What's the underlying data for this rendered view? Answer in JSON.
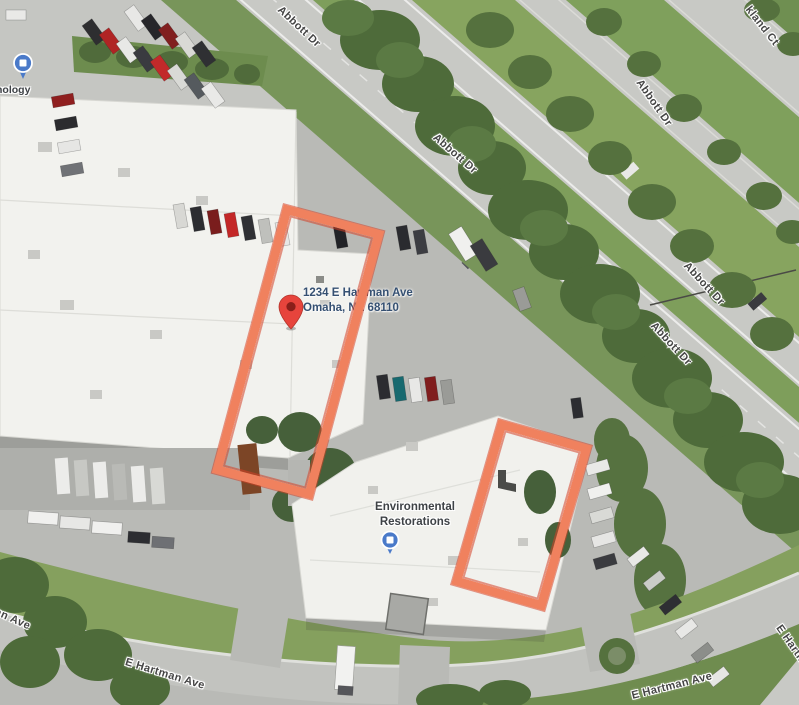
{
  "map": {
    "marker": {
      "address_line1": "1234 E Hartman Ave",
      "address_line2": "Omaha, NE 68110"
    },
    "poi": {
      "name_line1": "Environmental",
      "name_line2": "Restorations"
    },
    "poi_topleft": {
      "label_fragment": "nology"
    },
    "labels": {
      "abbott": "Abbott Dr",
      "hartman": "E Hartman Ave",
      "corner_ct": "kland Ct"
    },
    "colors": {
      "annotation_rectangle": "#F0815E",
      "annotation_edge": "#D33F26",
      "marker_red": "#E7443C",
      "poi_pin_blue": "#4A7AC9",
      "road_label_text": "#454545",
      "address_text": "#355072",
      "roof_white": "#F2F2EE",
      "asphalt": "#B9BAB6",
      "tree_green": "#4E6B3A"
    }
  }
}
